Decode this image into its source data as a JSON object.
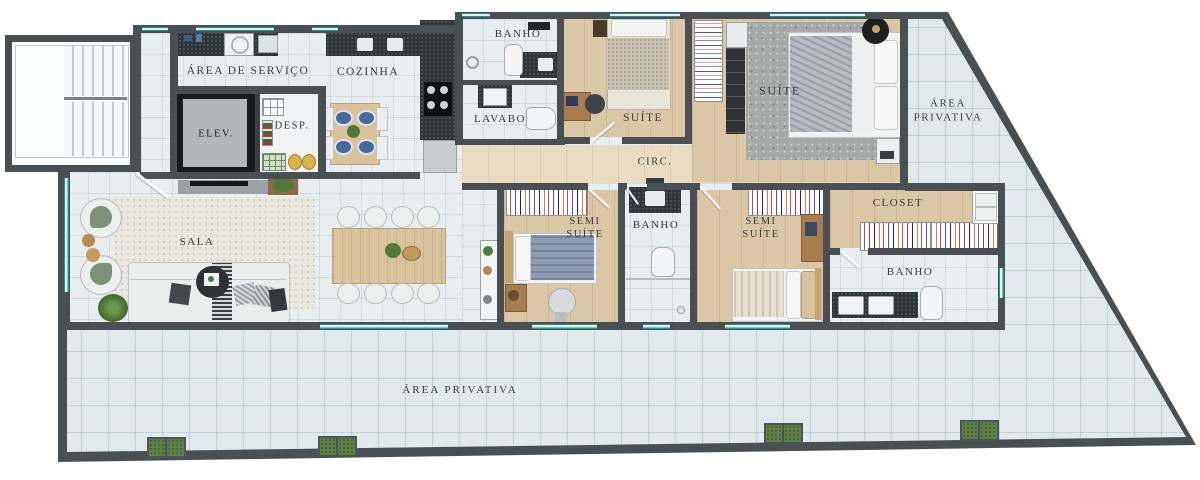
{
  "plan_type": "apartment-floor-plan",
  "rooms": {
    "area_servico": {
      "label": "ÁREA DE SERVIÇO"
    },
    "cozinha": {
      "label": "COZINHA"
    },
    "elev": {
      "label": "ELEV."
    },
    "desp": {
      "label": "DESP."
    },
    "banho_top": {
      "label": "BANHO"
    },
    "lavabo": {
      "label": "LAVABO"
    },
    "suite": {
      "label": "SUÍTE"
    },
    "suite_master": {
      "label": "SUÍTE"
    },
    "area_privativa_top": {
      "line1": "ÁREA",
      "line2": "PRIVATIVA"
    },
    "circ": {
      "label": "CIRC."
    },
    "sala": {
      "label": "SALA"
    },
    "semi_suite_1": {
      "line1": "SEMI",
      "line2": "SUÍTE"
    },
    "banho_mid": {
      "label": "BANHO"
    },
    "semi_suite_2": {
      "line1": "SEMI",
      "line2": "SUÍTE"
    },
    "closet": {
      "label": "CLOSET"
    },
    "banho_right": {
      "label": "BANHO"
    },
    "area_privativa_bottom": {
      "label": "ÁREA  PRIVATIVA"
    }
  },
  "colors": {
    "wall": "#4a4f53",
    "floor_tile": "#e2e9ec",
    "wood": "#dbc7a5",
    "window_accent": "#1f9488",
    "counter_dark": "#30353a",
    "label_text": "#383c40"
  }
}
